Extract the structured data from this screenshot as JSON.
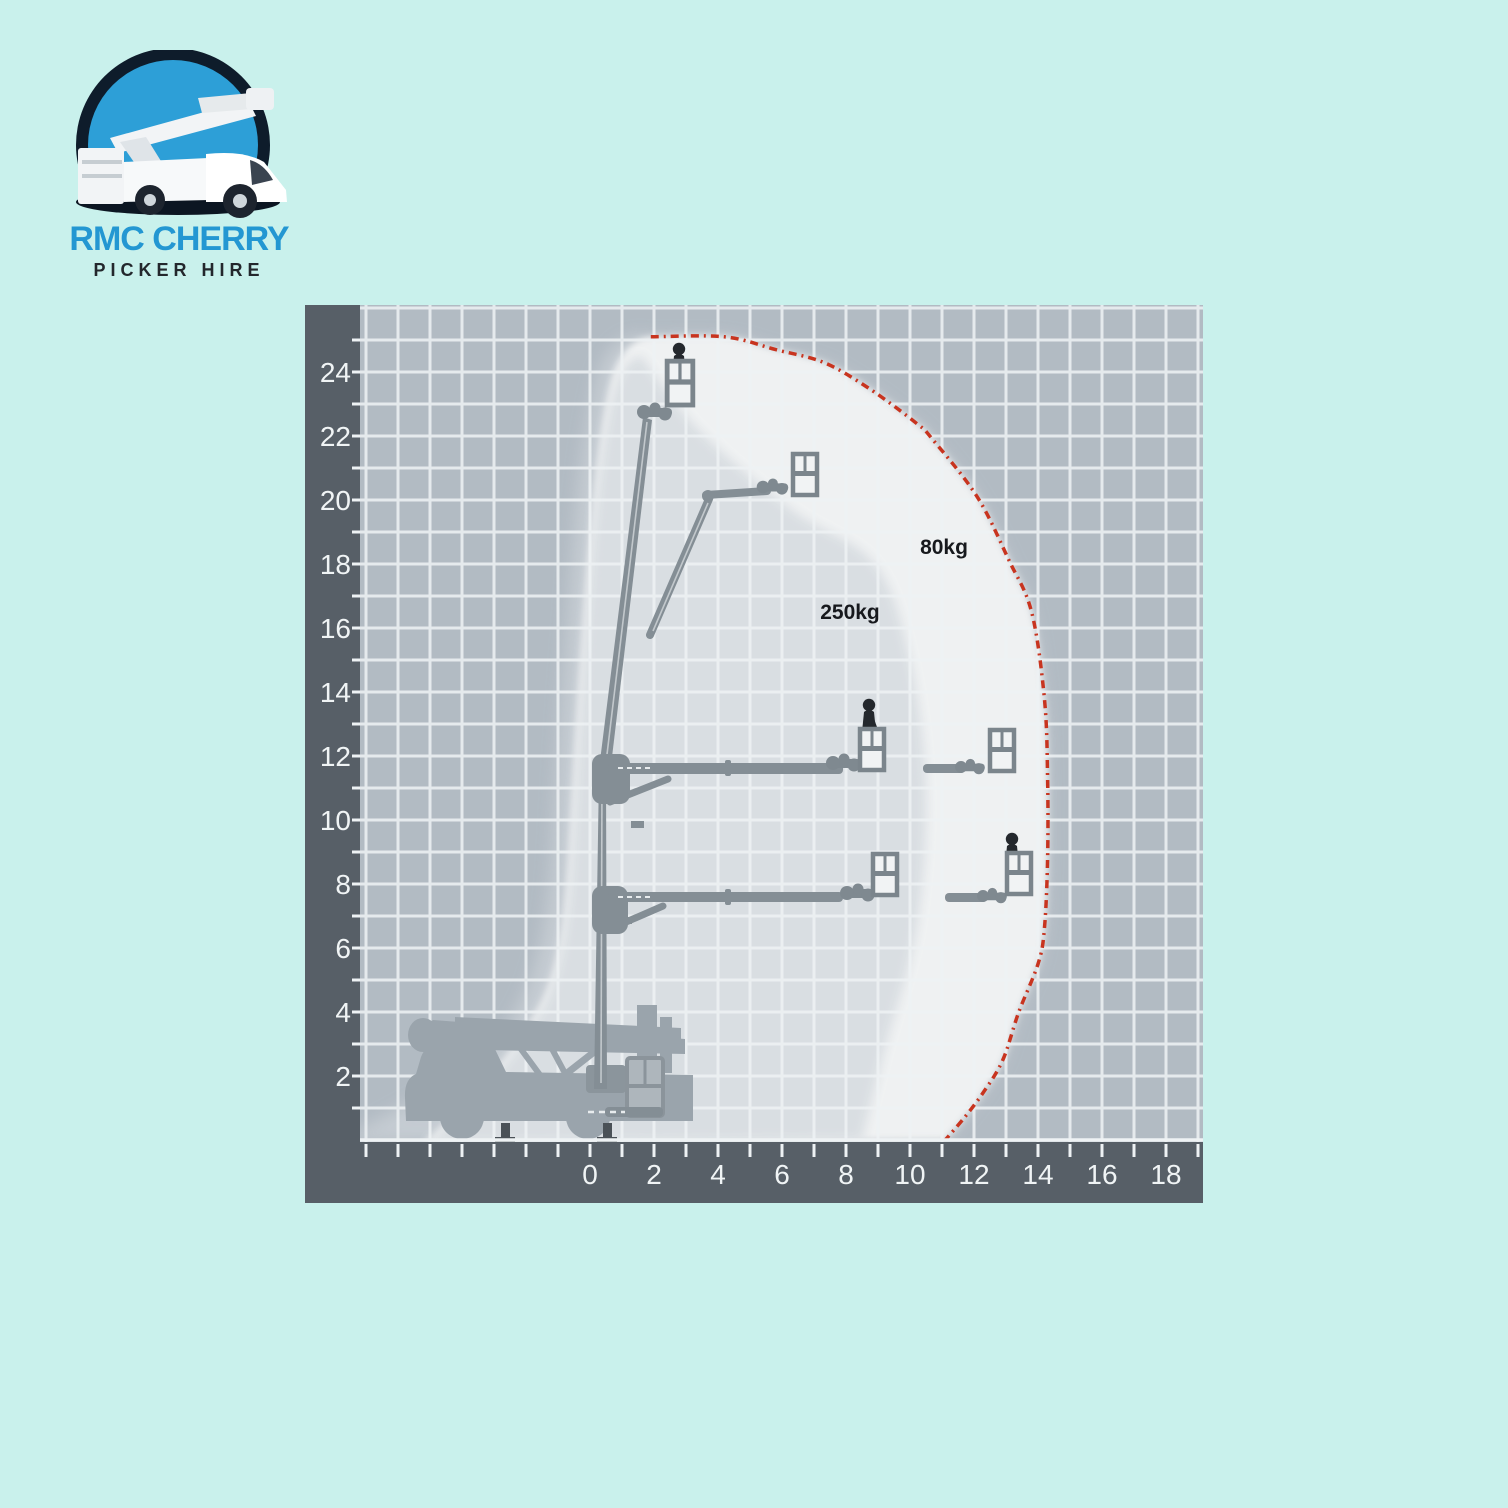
{
  "logo": {
    "title": "RMC CHERRY",
    "subtitle": "PICKER HIRE"
  },
  "chart": {
    "load_labels": {
      "outer": "80kg",
      "inner": "250kg"
    },
    "x_axis": {
      "tick_labels": [
        0,
        2,
        4,
        6,
        8,
        10,
        12,
        14,
        16,
        18
      ]
    },
    "y_axis": {
      "tick_labels": [
        2,
        4,
        6,
        8,
        10,
        12,
        14,
        16,
        18,
        20,
        22,
        24
      ]
    }
  },
  "chart_data": {
    "type": "area",
    "title": "",
    "xlabel": "",
    "ylabel": "",
    "xlim": [
      -7.2,
      19.2
    ],
    "ylim": [
      0,
      26.2
    ],
    "grid": true,
    "series": [
      {
        "name": "80kg",
        "points": [
          [
            1.9,
            25.1
          ],
          [
            4.2,
            25.1
          ],
          [
            5.8,
            24.7
          ],
          [
            7.3,
            24.3
          ],
          [
            8.7,
            23.5
          ],
          [
            10.2,
            22.4
          ],
          [
            10.7,
            21.9
          ],
          [
            12.1,
            20.1
          ],
          [
            13.1,
            18.1
          ],
          [
            13.8,
            16.5
          ],
          [
            14.2,
            13.8
          ],
          [
            14.3,
            11.3
          ],
          [
            14.3,
            8.8
          ],
          [
            14.2,
            6.6
          ],
          [
            14.0,
            5.5
          ],
          [
            13.4,
            4.0
          ],
          [
            12.9,
            2.5
          ],
          [
            12.3,
            1.5
          ],
          [
            11.7,
            0.7
          ],
          [
            11.1,
            0
          ]
        ]
      },
      {
        "name": "250kg",
        "points": [
          [
            1.6,
            24.5
          ],
          [
            3.4,
            22.2
          ],
          [
            6.3,
            19.7
          ],
          [
            8.9,
            18.0
          ],
          [
            10.0,
            15.0
          ],
          [
            10.5,
            10.9
          ],
          [
            10.2,
            6.6
          ],
          [
            9.2,
            2.8
          ],
          [
            8.5,
            0
          ]
        ]
      }
    ]
  },
  "colors": {
    "background": "#c9f1ec",
    "axis_band": "#575f67",
    "grid_bg": "#b2bbc3",
    "grid_line": "#eef2f4",
    "envelope_outer": "#eff1f2",
    "envelope_inner": "#d9dee2",
    "envelope_halo": "#c7ced4",
    "outline_red": "#c8341f",
    "boom_gray": "#848e95",
    "truck_gray": "#9aa4ac",
    "figure_dark": "#24282d",
    "logo_blue": "#2397d2",
    "logo_navy": "#0e1c2b",
    "logo_circle_blue": "#2d9fd7"
  }
}
